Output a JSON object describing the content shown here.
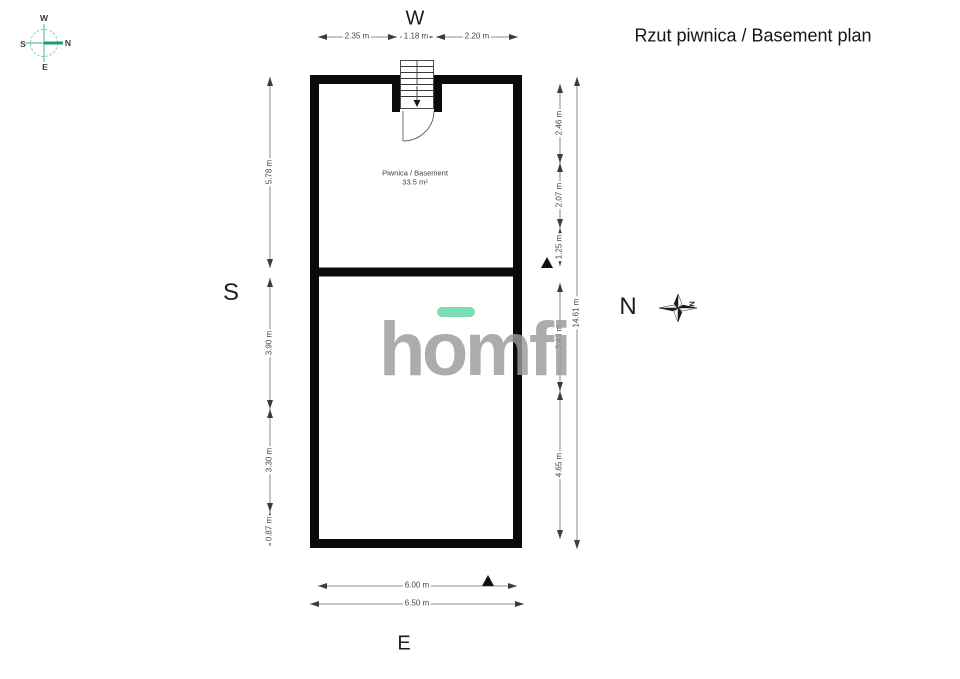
{
  "title": "Rzut piwnica / Basement plan",
  "side_labels": {
    "top": "W",
    "left": "S",
    "right": "N",
    "bottom": "E"
  },
  "compass_rose": {
    "top": "W",
    "right": "N",
    "bottom": "E",
    "left": "S"
  },
  "north_star_label": "N",
  "room": {
    "name": "Piwnica / Basement",
    "area": "33.5 m²"
  },
  "watermark": {
    "text": "homfi",
    "accent_color": "#5ed9a4",
    "text_color": "#9b9b9b"
  },
  "dimensions": {
    "top": [
      "2.35 m",
      "1.18 m",
      "2.20 m"
    ],
    "left": [
      "5.78 m",
      "3.90 m",
      "3.30 m",
      "0.87 m"
    ],
    "right_inner": [
      "2.46 m",
      "2.07 m",
      "1.25 m",
      "3.43 m",
      "4.65 m"
    ],
    "right_outer": "14.61 m",
    "bottom_inner": "6.00 m",
    "bottom_outer": "6.50 m"
  }
}
